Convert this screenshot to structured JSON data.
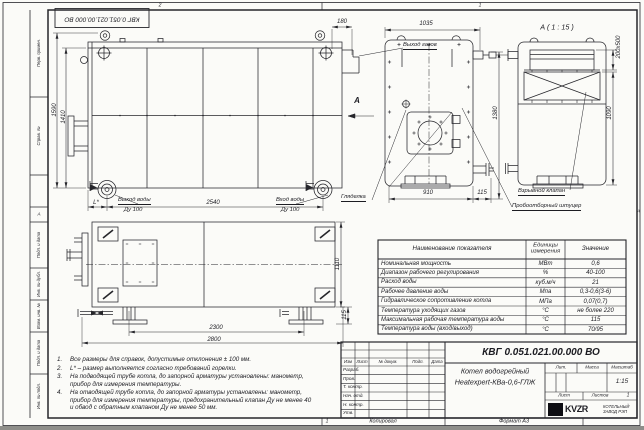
{
  "sheet": {
    "zone_top_left": "2",
    "zone_top_right": "1",
    "zone_bottom": "1",
    "zone_side": "А",
    "stamp": "КВГ 0.051.021.00.000 ВО",
    "left_fields": [
      "Перв. примен.",
      "Справ. №",
      "Подп. и дата",
      "Инв. № дубл.",
      "Взам. инв. №",
      "Подп. и дата",
      "Инв. № подл."
    ],
    "copy_label": "Копировал",
    "format_label": "Формат А3"
  },
  "views": {
    "side": {
      "dim_height_total": "1590",
      "dim_height_body": "1410",
      "dim_length": "2540",
      "dim_l": "L*",
      "dim_gas": "180",
      "label_gas_out": "Выход газов",
      "label_water_out": "Выход воды",
      "label_water_out_dn": "Ду 100",
      "label_water_in": "Вход воды",
      "label_water_in_dn": "Ду 100",
      "view_arrow": "А"
    },
    "front": {
      "dim_top": "1035",
      "dim_bottom": "910",
      "dim_offset": "115",
      "dim_height": "1380",
      "label_sight": "Гляделка"
    },
    "section": {
      "title": "А ( 1 : 15 )",
      "dim_opening": "200х500",
      "dim_height": "1090",
      "label_valve": "Взрывной клапан",
      "label_fitting": "Пробоотборный штуцер"
    },
    "plan": {
      "dim_span": "2300",
      "dim_length": "2800",
      "dim_width": "1110",
      "dim_foot": "115"
    }
  },
  "notes": {
    "items": [
      {
        "num": "1.",
        "text": "Все размеры для справок, допустимые отклонения ± 100 мм."
      },
      {
        "num": "2.",
        "text": "L* – размер выполняется согласно требований горелки."
      },
      {
        "num": "3.",
        "text": "На подводящей трубе котла, до запорной арматуры установлены: манометр, прибор для измерения температуры."
      },
      {
        "num": "4.",
        "text": "На отводящей трубе котла, до запорной арматуры установлены: манометр, прибор для измерения температуры, предохранительный клапан Ду не менее 40 и обвод с обратным клапаном Ду не менее 50 мм."
      }
    ]
  },
  "spec_table": {
    "col_name": "Наименование показателя",
    "col_units": "Единицы измерения",
    "col_value": "Значение",
    "rows": [
      {
        "name": "Номинальная мощность",
        "units": "МВт",
        "value": "0,6"
      },
      {
        "name": "Диапазон рабочего регулирования",
        "units": "%",
        "value": "40-100"
      },
      {
        "name": "Расход воды",
        "units": "куб.м/ч",
        "value": "21"
      },
      {
        "name": "Рабочее давление воды",
        "units": "Мпа",
        "value": "0,3-0,6(3-6)"
      },
      {
        "name": "Гидравлическое сопротивление котла",
        "units": "МПа",
        "value": "0,07(0,7)"
      },
      {
        "name": "Температура уходящих газов",
        "units": "°С",
        "value": "не более 220"
      },
      {
        "name": "Максимальная рабочая температура воды",
        "units": "°С",
        "value": "115"
      },
      {
        "name": "Температура воды (вход/выход)",
        "units": "°С",
        "value": "70/95"
      }
    ]
  },
  "title_block": {
    "doc_number": "КВГ 0.051.021.00.000 ВО",
    "product_name_1": "Котел водогрейный",
    "product_name_2": "Heatexpert-КВа-0,6-ГЛЖ",
    "header_cells": [
      "Изм",
      "Лист",
      "№ докум.",
      "Подп.",
      "Дата"
    ],
    "roles": [
      "Разраб.",
      "Пров.",
      "Т. контр.",
      "Нач. отд.",
      "Н. контр.",
      "Утв."
    ],
    "lit_label": "Лит.",
    "mass_label": "Масса",
    "scale_label": "Масштаб",
    "scale_value": "1:15",
    "sheet_label": "Лист",
    "sheets_label": "Листов",
    "sheets_value": "1",
    "logo_text": "KVZR",
    "company_line1": "КОТЕЛЬНЫЙ",
    "company_line2": "ЗАВОД РЭП"
  }
}
